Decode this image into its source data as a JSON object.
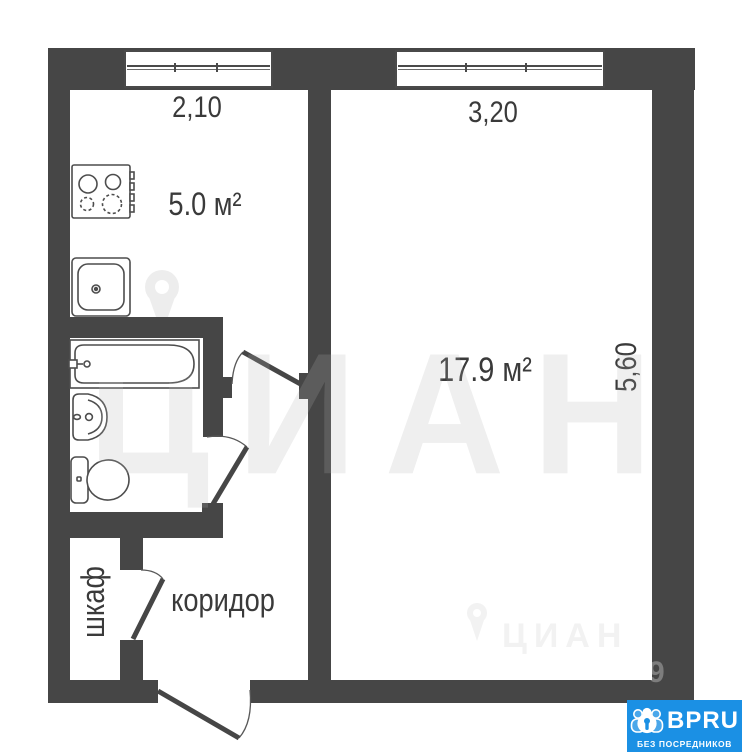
{
  "floorplan": {
    "rooms": {
      "kitchen": {
        "area": "5.0 м²"
      },
      "living_room": {
        "area": "17.9 м²"
      },
      "corridor": {
        "name": "коридор"
      },
      "closet": {
        "name": "шкаф"
      }
    },
    "dimensions": {
      "kitchen_width_m": "2,10",
      "room_width_m": "3,20",
      "room_depth_m": "5,60"
    },
    "colors": {
      "wall": "#464646",
      "fixture_line": "#4d4d4d",
      "watermark_gray": "#ededed",
      "badge_blue": "#1b90e4"
    }
  },
  "watermark": {
    "brand_large": "ЦИАН",
    "brand_small": "ЦИАН",
    "faint_digits": "9"
  },
  "badge": {
    "brand": "BPRU",
    "tagline": "БЕЗ ПОСРЕДНИКОВ"
  }
}
